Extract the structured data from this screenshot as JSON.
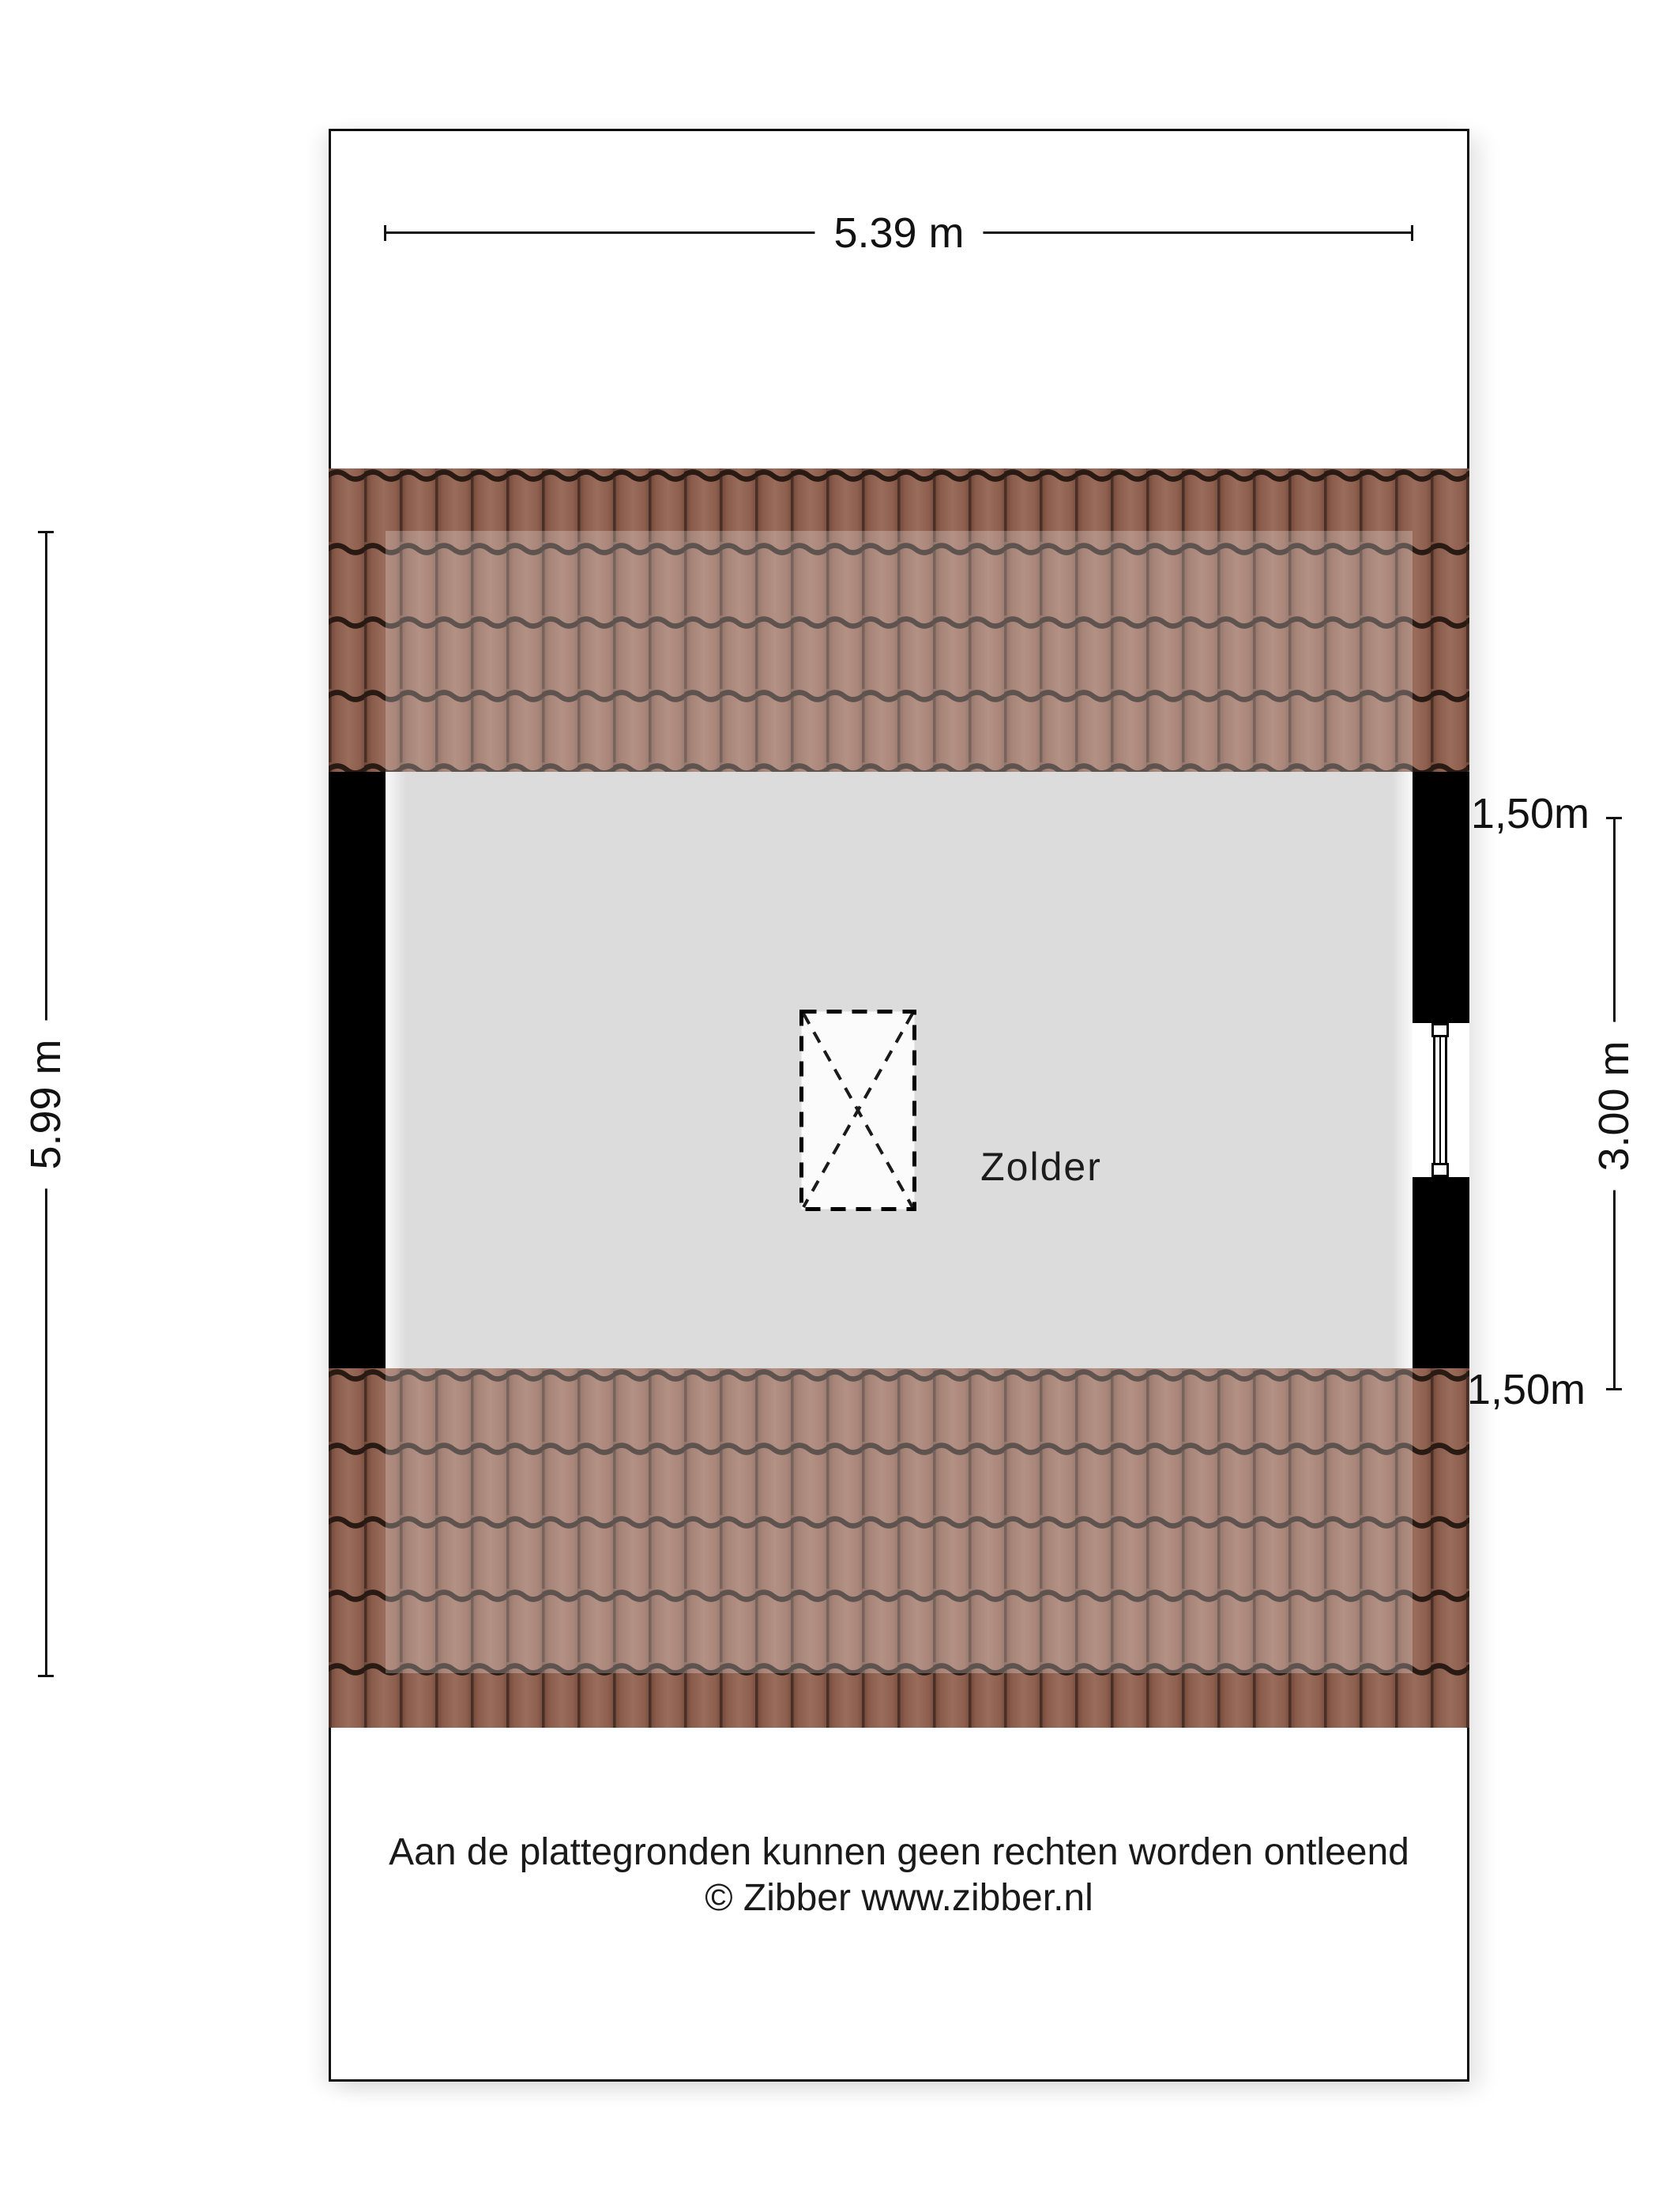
{
  "floorplan": {
    "room_label": "Zolder",
    "dimensions": {
      "top_width": "5.39 m",
      "left_height": "5.99 m",
      "right_span": "3.00 m",
      "right_top_height": "1,50m",
      "right_bottom_height": "1,50m"
    },
    "footer": {
      "disclaimer": "Aan de plattegronden kunnen geen rechten worden ontleend",
      "copyright": "© Zibber www.zibber.nl"
    },
    "colors": {
      "roof_tile_base": "#9a6c5b",
      "roof_tile_edge": "#6d4537",
      "roof_joint_dark": "#2a1a14",
      "roof_overlay_highlight": "rgba(255,255,255,0.25)",
      "interior_floor": "#dcdcdc",
      "wall": "#000000",
      "dimension_ink": "#121212",
      "background": "#ffffff"
    }
  }
}
